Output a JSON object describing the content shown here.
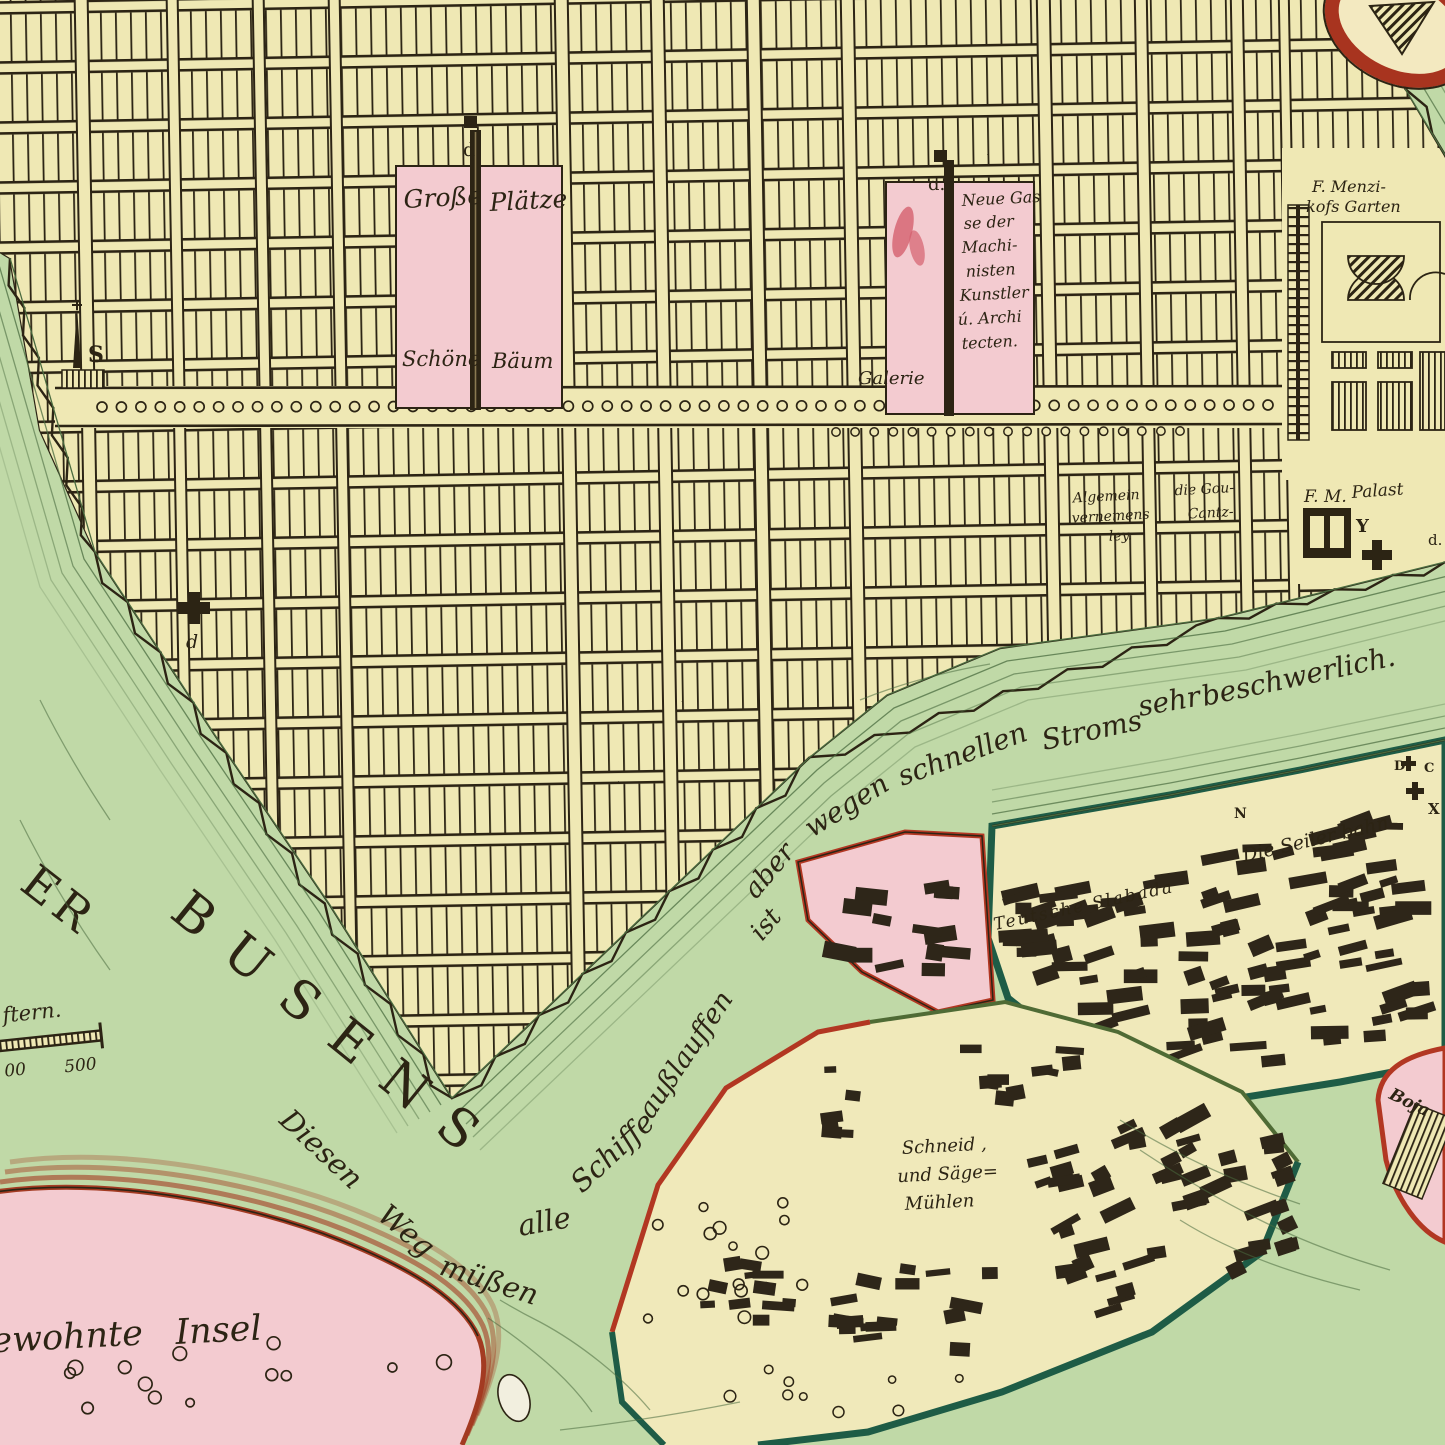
{
  "plaza": {
    "grosse": "Große",
    "plaetze": "Plätze",
    "schoene": "Schöne",
    "baeum": "Bäum",
    "marker_d1": "d",
    "marker_d2": "d."
  },
  "neue_gasse": {
    "lines": [
      "Neue Gas",
      "se der",
      "Machi-",
      "nisten",
      "Kunstler",
      "ú. Archi",
      "tecten."
    ],
    "galerie": "Galerie"
  },
  "menzikoff": {
    "line1": "F. Menzi-",
    "line2": "kofs Garten"
  },
  "gouvernement": {
    "left": [
      "Algemein",
      "vernemens",
      "ley."
    ],
    "right": [
      "die Gou-",
      "Cantz-"
    ]
  },
  "palast": {
    "fm": "F. M.",
    "palast": "Palast",
    "y": "Y",
    "q": "Q",
    "d": "d."
  },
  "slabada": {
    "teutsche": "Teutsche Slabada",
    "seilerbahn": "Die Seiler bahn",
    "n": "N",
    "d": "D",
    "c": "C",
    "x": "X"
  },
  "river_note": {
    "words": [
      "Diesen",
      "Weg",
      "müßen",
      "alle",
      "Schiffe",
      "außlauffen",
      "ist",
      "aber",
      "wegen",
      "schnellen",
      "Stroms",
      "sehr",
      "beschwerlich."
    ]
  },
  "water_labels": {
    "busens_er": "ER",
    "busens": "BUSENS"
  },
  "scale_bar": {
    "caption": "ftern.",
    "tick_left": "00",
    "tick_right": "500"
  },
  "south": {
    "schneid_lines": [
      "Schneid ,",
      "und Säge=",
      "Mühlen"
    ],
    "insel": [
      "ewohnte",
      "Insel"
    ],
    "boja": "Boja"
  },
  "church": {
    "s": "S",
    "d": "d"
  },
  "colors": {
    "parchment": "#efe8b4",
    "pink": "#f3cbd0",
    "water": "#c0d9a7",
    "ink": "#2c2414",
    "contour": "#4a6b3f",
    "teal": "#1e5c46",
    "red": "#b23722"
  }
}
